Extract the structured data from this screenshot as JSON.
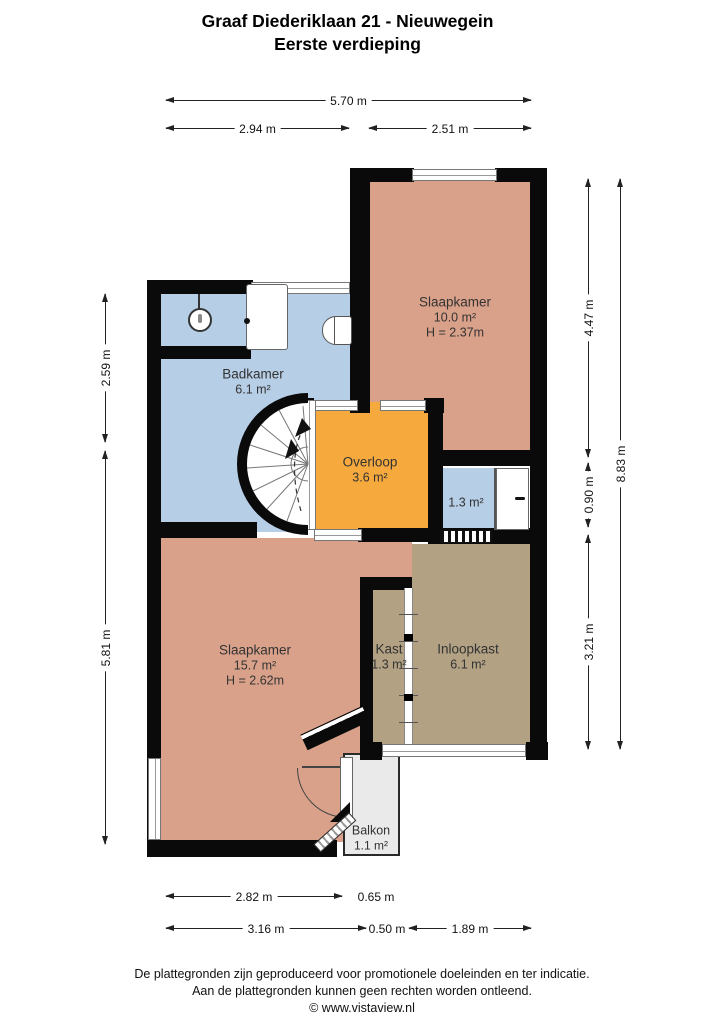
{
  "title": {
    "line1": "Graaf Diederiklaan 21 - Nieuwegein",
    "line2": "Eerste verdieping"
  },
  "rooms": {
    "slaapkamer1": {
      "name": "Slaapkamer",
      "area": "10.0 m²",
      "ceiling": "H = 2.37m"
    },
    "badkamer": {
      "name": "Badkamer",
      "area": "6.1 m²"
    },
    "overloop": {
      "name": "Overloop",
      "area": "3.6 m²"
    },
    "berging": {
      "area": "1.3 m²"
    },
    "slaapkamer2": {
      "name": "Slaapkamer",
      "area": "15.7 m²",
      "ceiling": "H = 2.62m"
    },
    "kast": {
      "name": "Kast",
      "area": "1.3 m²"
    },
    "inloopkast": {
      "name": "Inloopkast",
      "area": "6.1 m²"
    },
    "balkon": {
      "name": "Balkon",
      "area": "1.1 m²"
    }
  },
  "dimensions": {
    "top_total": "5.70 m",
    "top_left": "2.94 m",
    "top_right": "2.51 m",
    "left_upper": "2.59 m",
    "left_lower": "5.81 m",
    "right_upper": "4.47 m",
    "right_middle": "0.90 m",
    "right_lower": "3.21 m",
    "right_total": "8.83 m",
    "bottom1_left": "2.82 m",
    "bottom1_right": "0.65 m",
    "bottom2_left": "3.16 m",
    "bottom2_middle": "0.50 m",
    "bottom2_right": "1.89 m"
  },
  "footer": {
    "line1": "De plattegronden zijn geproduceerd voor promotionele doeleinden en ter indicatie.",
    "line2": "Aan de plattegronden kunnen geen rechten worden ontleend.",
    "line3": "© www.vistaview.nl"
  },
  "colors": {
    "wall": "#0a0a0a",
    "bedroom": "#d9a18a",
    "bathroom": "#b7cee7",
    "landing": "#f6a93d",
    "closet_room": "#b2a183",
    "balcony": "#eaeaea"
  }
}
